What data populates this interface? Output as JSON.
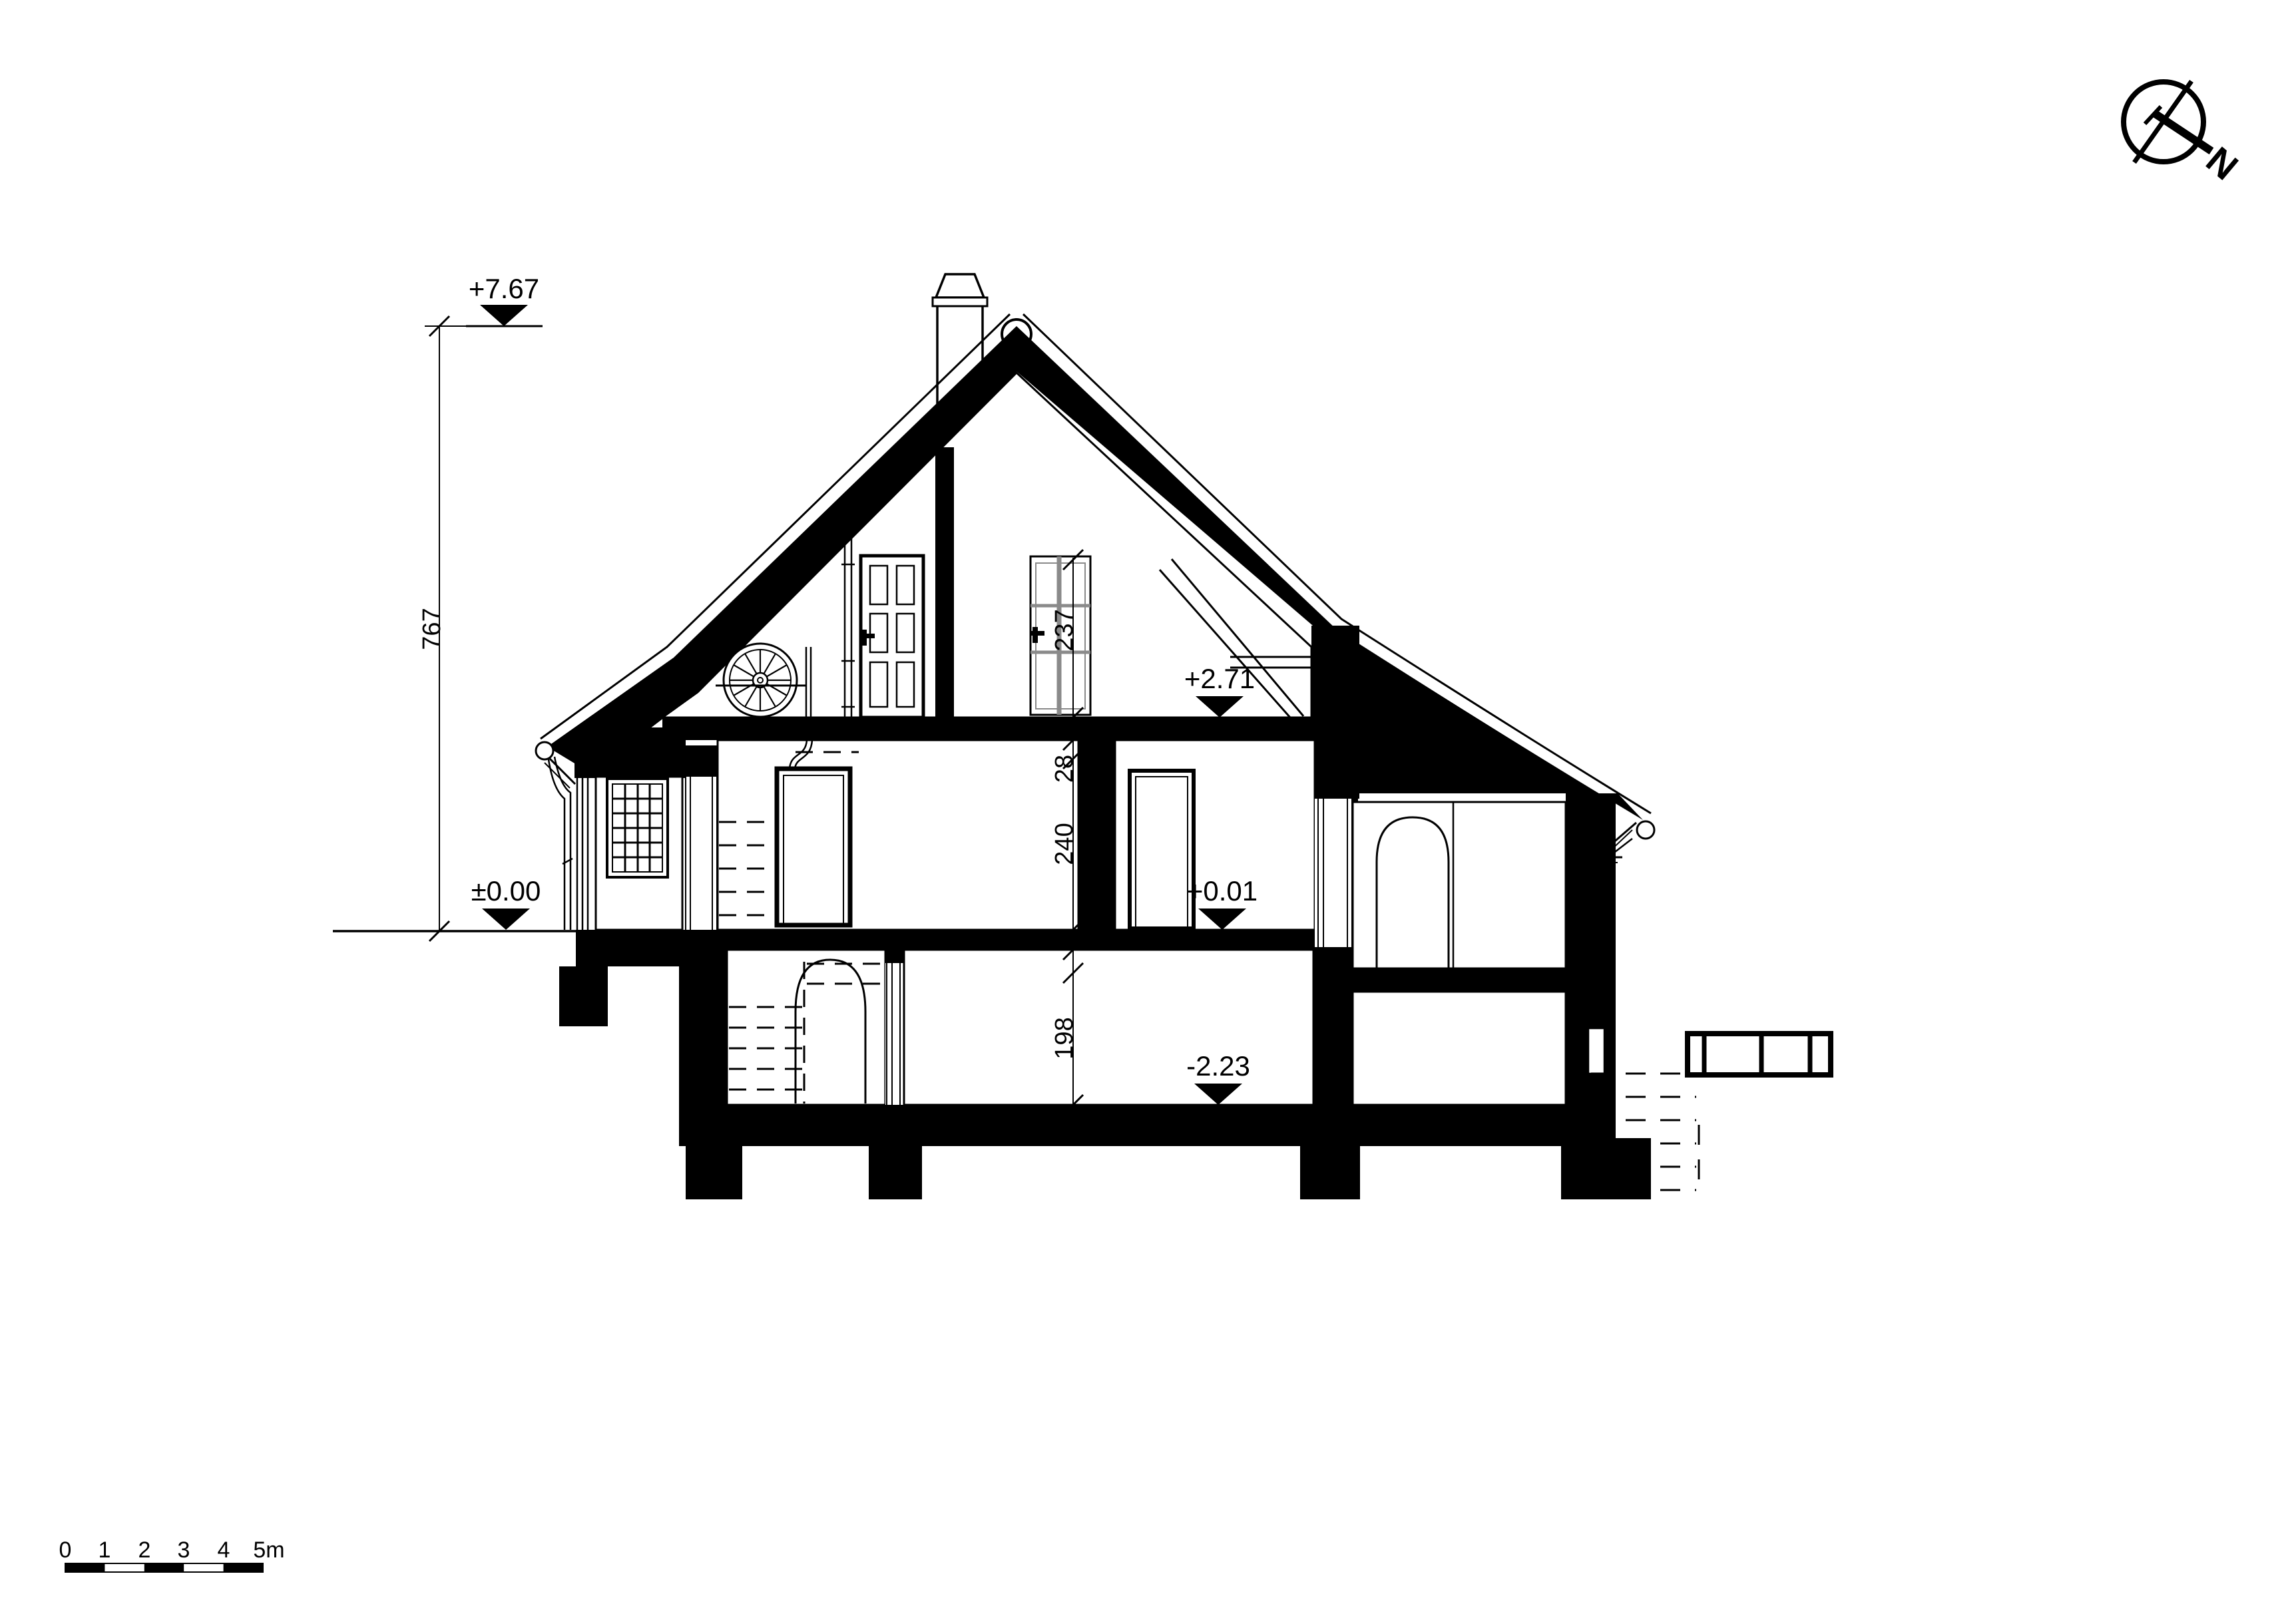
{
  "annotations": {
    "levels": {
      "ridge": "+7.67",
      "ground": "±0.00",
      "attic": "+2.71",
      "floor": "+0.01",
      "basement": "-2.23"
    },
    "dims": {
      "total_height": "767",
      "attic_height": "237",
      "slab_buildup": "28",
      "ground_height": "240",
      "basement_height": "198"
    },
    "north": "N",
    "scale": {
      "t0": "0",
      "t1": "1",
      "t2": "2",
      "t3": "3",
      "t4": "4",
      "t5": "5m"
    }
  },
  "colors": {
    "ink": "#000000",
    "mullion_grey": "#8a8a8a"
  }
}
